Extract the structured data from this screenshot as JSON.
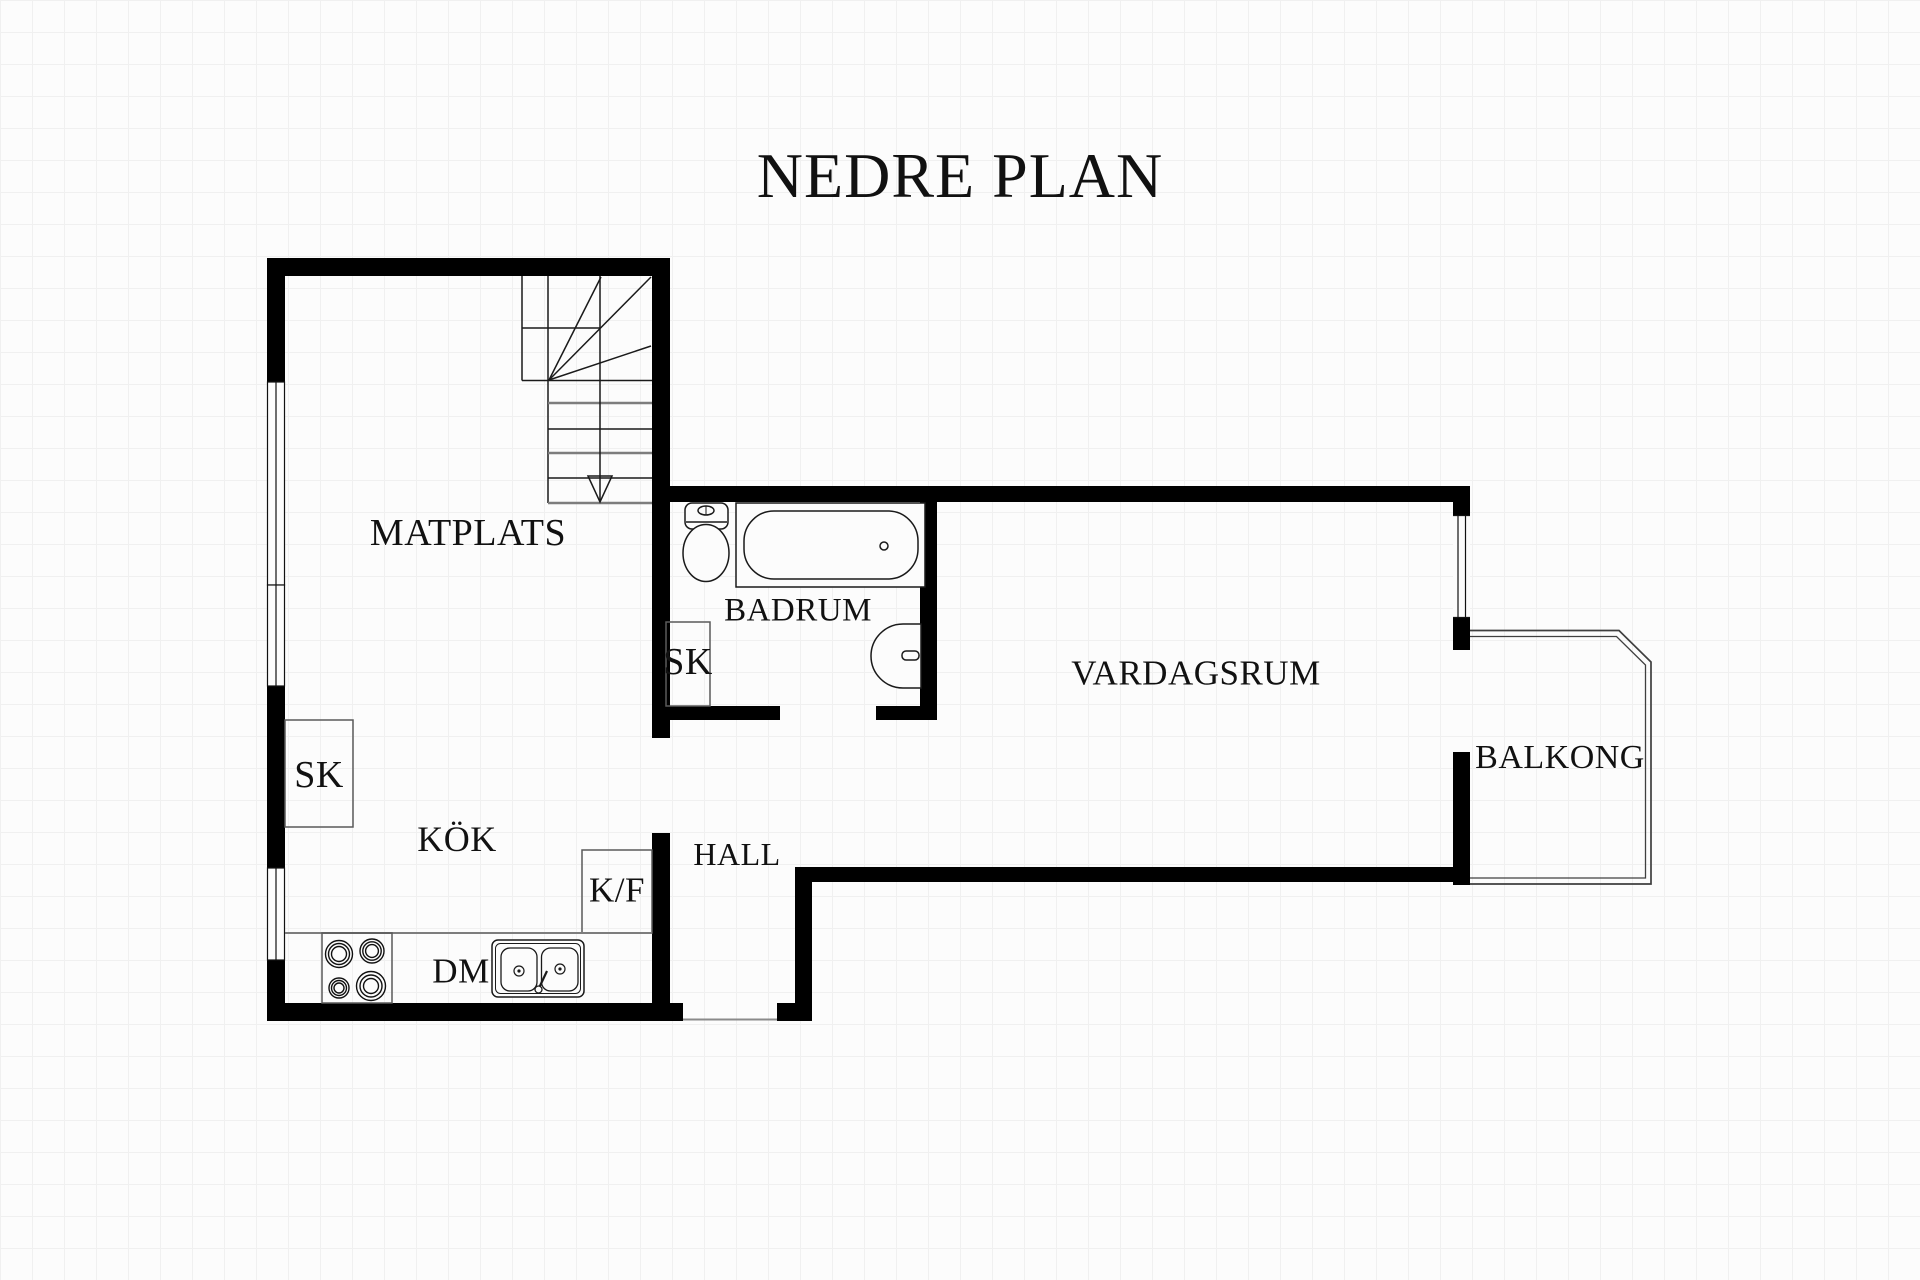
{
  "title": "NEDRE PLAN",
  "rooms": {
    "matplats": {
      "label": "MATPLATS"
    },
    "badrum": {
      "label": "BADRUM"
    },
    "vardagsrum": {
      "label": "VARDAGSRUM"
    },
    "balkong": {
      "label": "BALKONG"
    },
    "kok": {
      "label": "KÖK"
    },
    "hall": {
      "label": "HALL"
    }
  },
  "fixtures": {
    "closet_bathroom": {
      "label": "SK"
    },
    "closet_kitchen": {
      "label": "SK"
    },
    "fridge_freezer": {
      "label": "K/F"
    },
    "dishwasher": {
      "label": "DM"
    }
  },
  "colors": {
    "wall": "#000000",
    "fixture_line": "#1a1a1a",
    "gray_line": "#7d7d7d",
    "box_line": "#5a5a5a",
    "balcony_line": "#3f3f3f",
    "background": "#fcfcfc",
    "grid_line": "#f0f0f0",
    "text": "#111111"
  }
}
